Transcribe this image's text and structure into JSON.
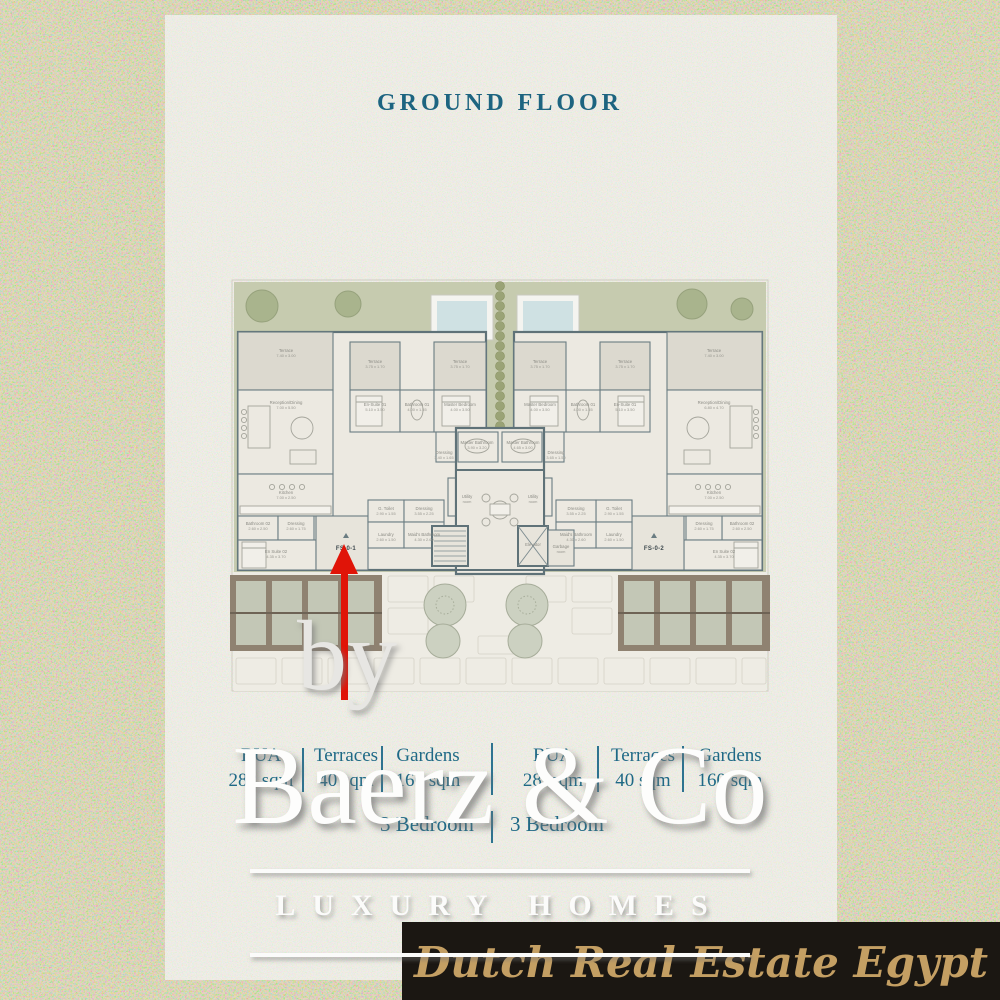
{
  "title": "GROUND FLOOR",
  "watermarks": {
    "by": "by",
    "brand": "Baerz & Co",
    "tagline": "LUXURY HOMES"
  },
  "footer": {
    "agency": "Dutch Real Estate Egypt"
  },
  "stats": {
    "left": {
      "bua_label": "BUA",
      "bua": "282 sqm",
      "terraces_label": "Terraces",
      "terraces": "40 sqm",
      "gardens_label": "Gardens",
      "gardens": "160 sqm",
      "bedrooms": "3 Bedroom"
    },
    "right": {
      "bua_label": "BUA",
      "bua": "282sqm",
      "terraces_label": "Terraces",
      "terraces": "40 sqm",
      "gardens_label": "Gardens",
      "gardens": "160 sqm",
      "bedrooms": "3 Bedroom"
    }
  },
  "plan": {
    "unit1": {
      "tag": "FS-0-1"
    },
    "unit2": {
      "tag": "FS-0-2"
    },
    "labels": [
      {
        "x": 56,
        "y": 74,
        "t": "Terrace",
        "d": "7.40 x 3.00"
      },
      {
        "x": 56,
        "y": 126,
        "t": "Reception/Dining",
        "d": "7.00 x 5.50"
      },
      {
        "x": 56,
        "y": 216,
        "t": "Kitchen",
        "d": "7.00 x 2.50"
      },
      {
        "x": 28,
        "y": 247,
        "t": "Bathroom 02",
        "d": "2.60 x 2.50"
      },
      {
        "x": 66,
        "y": 247,
        "t": "Dressing",
        "d": "2.60 x 1.75"
      },
      {
        "x": 46,
        "y": 275,
        "t": "En Suite 02",
        "d": "4.35 x 3.70"
      },
      {
        "x": 145,
        "y": 85,
        "t": "Terrace",
        "d": "3.75 x 1.70"
      },
      {
        "x": 145,
        "y": 128,
        "t": "En-Suite 01",
        "d": "5.10 x 3.50"
      },
      {
        "x": 187,
        "y": 128,
        "t": "Bathroom 01",
        "d": "4.00 x 1.55"
      },
      {
        "x": 156,
        "y": 232,
        "t": "G. Toilet",
        "d": "2.90 x 1.55"
      },
      {
        "x": 194,
        "y": 232,
        "t": "Dressing",
        "d": "3.55 x 2.25"
      },
      {
        "x": 156,
        "y": 258,
        "t": "Laundry",
        "d": "2.60 x 1.50"
      },
      {
        "x": 194,
        "y": 258,
        "t": "Maid's Bathroom",
        "d": "4.30 x 2.60"
      },
      {
        "x": 230,
        "y": 85,
        "t": "Terrace",
        "d": "3.75 x 1.70"
      },
      {
        "x": 230,
        "y": 128,
        "t": "Master Bedroom",
        "d": "4.00 x 3.50"
      },
      {
        "x": 247,
        "y": 166,
        "t": "Master Bathroom",
        "d": "3.90 x 3.20"
      },
      {
        "x": 214,
        "y": 176,
        "t": "Dressing",
        "d": "3.40 x 1.65"
      },
      {
        "x": 237,
        "y": 220,
        "t": "Utility",
        "d": "room"
      },
      {
        "x": 303,
        "y": 268,
        "t": "Elevator",
        "d": ""
      },
      {
        "x": 331,
        "y": 270,
        "t": "Garbage",
        "d": "room"
      },
      {
        "x": 484,
        "y": 74,
        "t": "Terrace",
        "d": "7.40 x 3.00"
      },
      {
        "x": 484,
        "y": 126,
        "t": "Reception/Dining",
        "d": "6.80 x 4.70"
      },
      {
        "x": 484,
        "y": 216,
        "t": "Kitchen",
        "d": "7.00 x 2.50"
      },
      {
        "x": 512,
        "y": 247,
        "t": "Bathroom 02",
        "d": "2.60 x 2.50"
      },
      {
        "x": 474,
        "y": 247,
        "t": "Dressing",
        "d": "2.60 x 1.75"
      },
      {
        "x": 494,
        "y": 275,
        "t": "En Suite 02",
        "d": "4.35 x 3.70"
      },
      {
        "x": 395,
        "y": 85,
        "t": "Terrace",
        "d": "3.75 x 1.70"
      },
      {
        "x": 395,
        "y": 128,
        "t": "En-Suite 01",
        "d": "5.10 x 3.50"
      },
      {
        "x": 353,
        "y": 128,
        "t": "Bathroom 01",
        "d": "4.00 x 1.55"
      },
      {
        "x": 384,
        "y": 232,
        "t": "G. Toilet",
        "d": "2.90 x 1.55"
      },
      {
        "x": 346,
        "y": 232,
        "t": "Dressing",
        "d": "3.55 x 2.25"
      },
      {
        "x": 384,
        "y": 258,
        "t": "Laundry",
        "d": "2.60 x 1.50"
      },
      {
        "x": 346,
        "y": 258,
        "t": "Maid's Bathroom",
        "d": "4.30 x 2.60"
      },
      {
        "x": 310,
        "y": 85,
        "t": "Terrace",
        "d": "3.75 x 1.70"
      },
      {
        "x": 310,
        "y": 128,
        "t": "Master Bedroom",
        "d": "4.00 x 3.50"
      },
      {
        "x": 293,
        "y": 166,
        "t": "Master Bathroom",
        "d": "4.65 x 3.00"
      },
      {
        "x": 326,
        "y": 176,
        "t": "Dressing",
        "d": "3.65 x 1.50"
      },
      {
        "x": 303,
        "y": 220,
        "t": "Utility",
        "d": "room"
      }
    ]
  },
  "colors": {
    "teal_text": "#1f6986",
    "lawn": "#c6cbaf",
    "pool_water": "#cfe1e3",
    "wall": "#5f7278",
    "room_fill": "#ece9e1",
    "terrace_fill": "#dcd9cf",
    "pergola_frame": "#8f8271",
    "bar_bg": "#1b1712",
    "gold": "#c49f63",
    "arrow_red": "#e01408",
    "panel": "#f2f0e9",
    "background": "#e4ddbc"
  }
}
